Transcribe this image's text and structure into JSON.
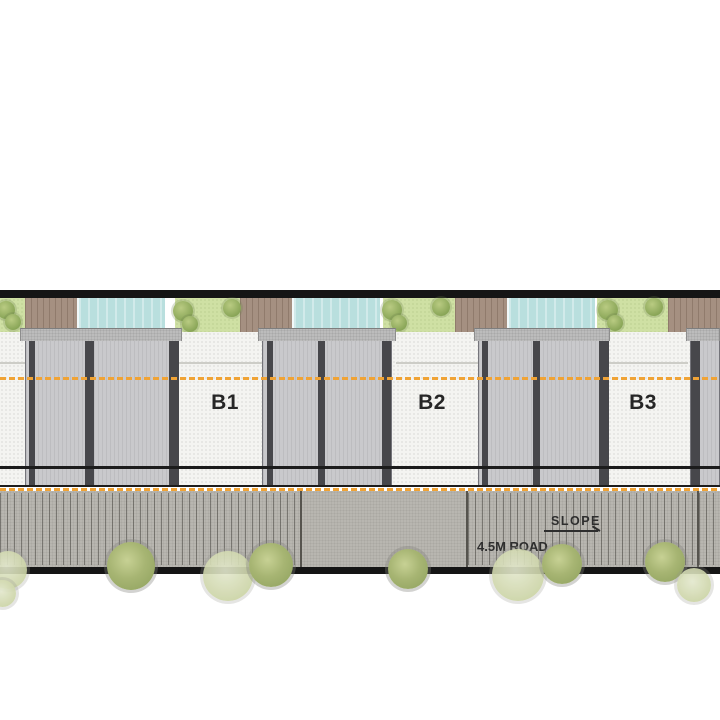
{
  "units": [
    {
      "label": "B1"
    },
    {
      "label": "B2"
    },
    {
      "label": "B3"
    }
  ],
  "road": {
    "name": "4.5M ROAD",
    "slope_label": "SLOPE"
  },
  "colors": {
    "garden": "#cfe0a4",
    "deck": "#a59081",
    "pool": "#b9dfde",
    "house": "#c9c9cc",
    "wall": "#47474b",
    "yard": "#f4f4f1",
    "road": "#b8b6b0",
    "setback_line": "#f0a335",
    "boundary": "#151515",
    "tree_dark": "#a7b573",
    "tree_light": "#ccd4a6"
  }
}
